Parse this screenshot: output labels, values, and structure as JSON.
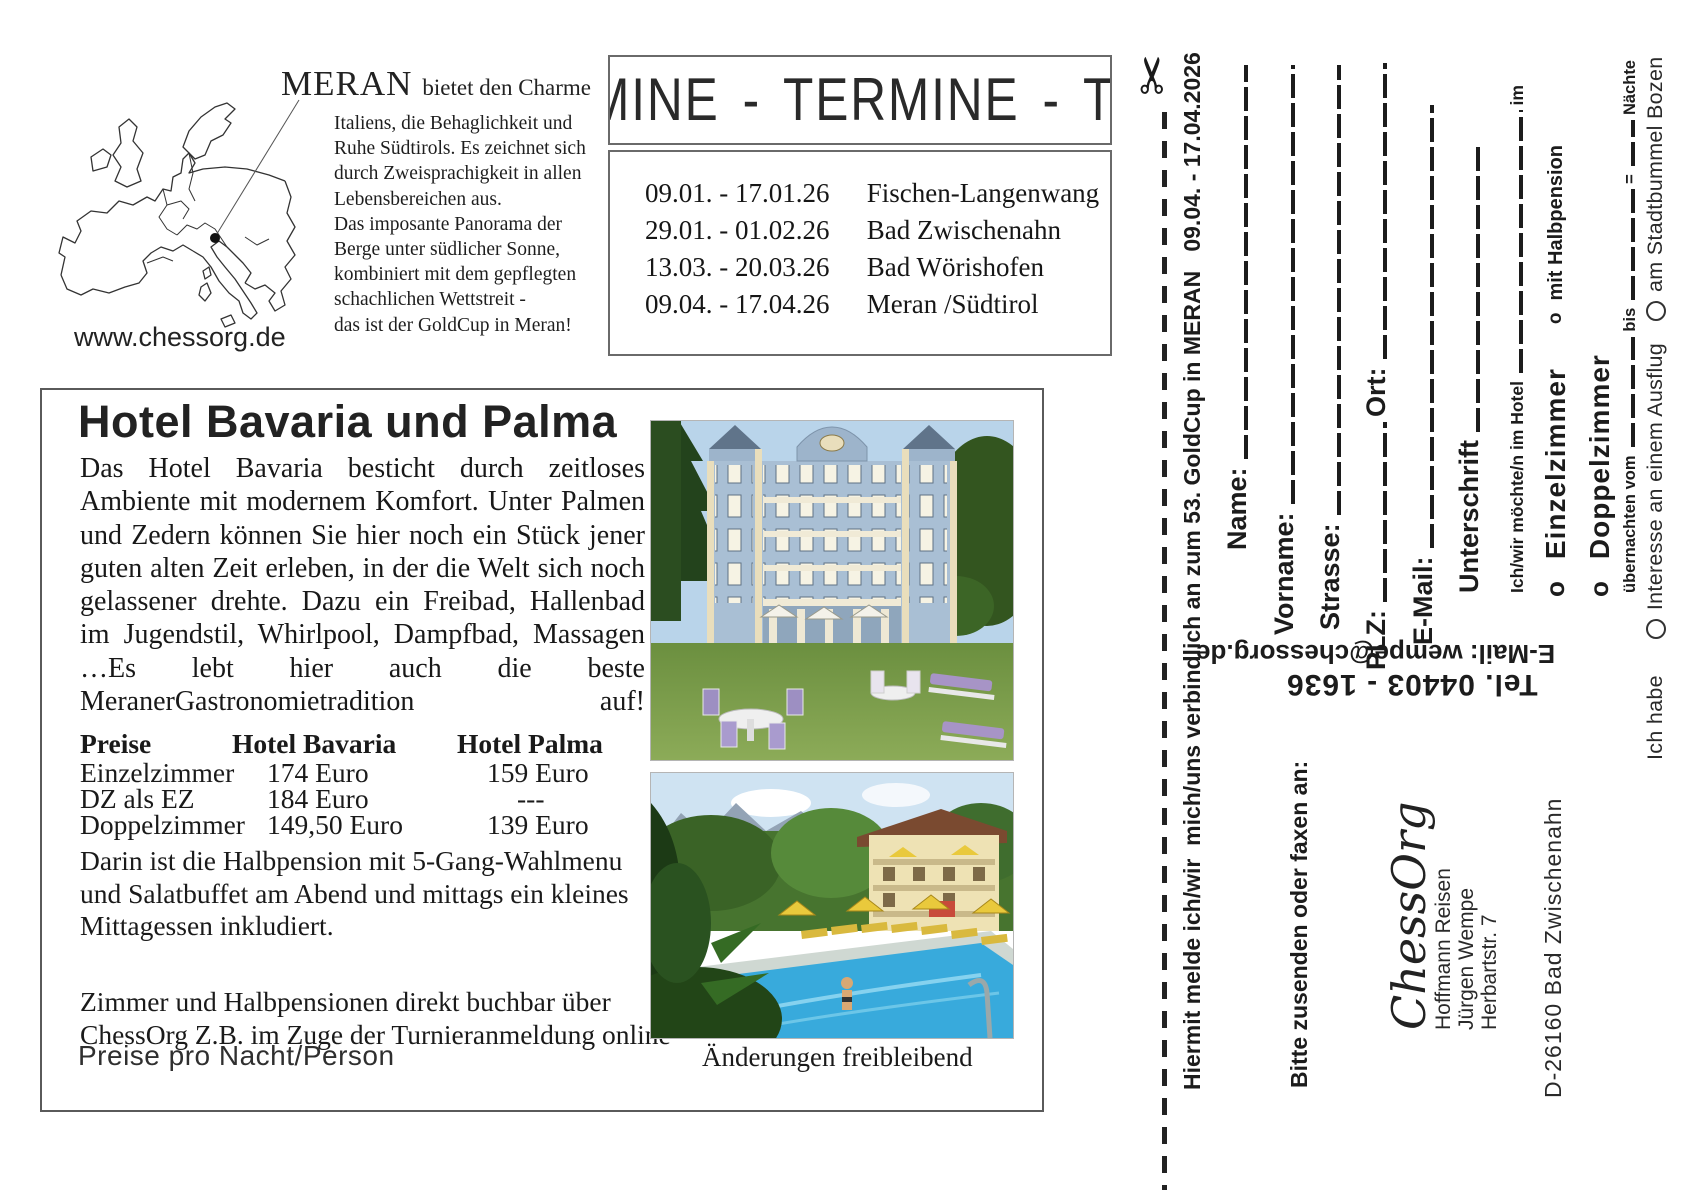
{
  "map_section": {
    "heading": "MERAN",
    "heading_suffix": "bietet den Charme",
    "description": "Italiens, die Behaglichkeit und\nRuhe Südtirols. Es zeichnet sich\ndurch Zweisprachigkeit in allen\nLebensbereichen aus.\nDas imposante Panorama der\nBerge unter südlicher Sonne,\nkombiniert mit dem gepflegten\nschachlichen Wettstreit -\ndas ist der GoldCup in Meran!",
    "website": "www.chessorg.de"
  },
  "termine": {
    "banner_text": "MINE  -  TERMINE  -  TERMINE",
    "events": [
      {
        "dates": "09.01. - 17.01.26",
        "location": "Fischen-Langenwang"
      },
      {
        "dates": "29.01. - 01.02.26",
        "location": "Bad Zwischenahn"
      },
      {
        "dates": "13.03. - 20.03.26",
        "location": "Bad Wörishofen"
      },
      {
        "dates": "09.04. - 17.04.26",
        "location": "Meran /Südtirol"
      }
    ]
  },
  "hotel_section": {
    "title": "Hotel Bavaria und Palma",
    "body": "Das Hotel Bavaria besticht durch zeitloses Ambiente mit modernem Komfort. Unter Palmen und Zedern können Sie hier noch ein Stück jener guten alten Zeit erleben, in der die Welt sich noch gelassener drehte. Dazu ein Freibad, Hallenbad im Jugendstil, Whirlpool, Dampfbad, Massagen …Es lebt hier auch die beste MeranerGastronomietradition auf!",
    "price_table": {
      "headers": [
        "Preise",
        "Hotel Bavaria",
        "Hotel Palma"
      ],
      "rows": [
        {
          "label": "Einzelzimmer",
          "bavaria": "174 Euro",
          "palma": "159 Euro"
        },
        {
          "label": "DZ als EZ",
          "bavaria": "184 Euro",
          "palma": "---"
        },
        {
          "label": "Doppelzimmer",
          "bavaria": "149,50 Euro",
          "palma": "139 Euro"
        }
      ]
    },
    "halbpension_note": "Darin ist die Halbpension mit 5-Gang-Wahlmenu\nund Salatbuffet am Abend und mittags ein kleines\nMittagessen inkludiert.",
    "booking_note": "Zimmer und Halbpensionen direkt buchbar über\nChessOrg Z.B. im Zuge der Turnieranmeldung online",
    "price_note": "Preise pro Nacht/Person",
    "photo_caption": "Änderungen freibleibend"
  },
  "form": {
    "header": "Hiermit melde ich/wir  mich/uns verbindlich an zum 53. GoldCup in MERAN   09.04. - 17.04.2026",
    "fields": {
      "name": "Name:",
      "vorname": "Vorname:",
      "strasse": "Strasse:",
      "plz": "PLZ:",
      "ort": "Ort:",
      "email": "E-Mail:",
      "unterschrift": "Unterschrift"
    },
    "hotel_line": {
      "prefix": "Ich/wir möchte/n im Hotel",
      "suffix": "im"
    },
    "bullet": "o",
    "room_options": [
      "Einzelzimmer",
      "Doppelzimmer"
    ],
    "halbpension_option": "mit Halbpension",
    "nights_line": {
      "part1": "übernachten vom",
      "part2": "bis",
      "part3": "=",
      "part4": "Nächte"
    },
    "interest_line": {
      "prefix": "Ich habe",
      "options": [
        "Interesse an einem Ausflug",
        "am Stadtbummel Bozen"
      ]
    },
    "contact": {
      "email": "E-Mail: wempe@chessorg.de",
      "tel": "Tel. 04403 - 1636"
    },
    "send_to": "Bitte zusenden oder faxen an:",
    "address": {
      "org": "ChessOrg",
      "lines": "Hoffmann Reisen\nJürgen Wempe\nHerbartstr. 7",
      "city": "D-26160 Bad Zwischenahn"
    }
  }
}
